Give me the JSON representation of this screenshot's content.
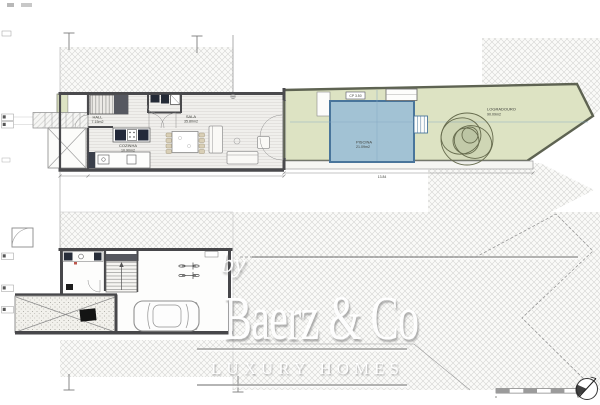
{
  "watermark": {
    "prefix": "by",
    "brand": "Baerz & Co",
    "tagline": "LUXURY HOMES"
  },
  "upper_floor": {
    "hall": {
      "name": "HALL",
      "area": "7.15m2"
    },
    "kitchen": {
      "name": "COZINHA",
      "area": "10.90m2"
    },
    "living": {
      "name": "SALA",
      "area": "35.80m2"
    },
    "pool": {
      "name": "PISCINA",
      "area": "21.09m2"
    },
    "garden": {
      "name": "LOGRADOURO",
      "area": "90.09m2"
    },
    "level_tag": "CP 3.50",
    "width_dimension": "13.84"
  },
  "scale_bar": {
    "start": "0",
    "end": "5"
  },
  "colors": {
    "garden_green": "#dde3c3",
    "pool_blue": "#a2c2d4",
    "wall_gray": "#4a4a4d",
    "hatch_gray": "#d4d4d2"
  }
}
